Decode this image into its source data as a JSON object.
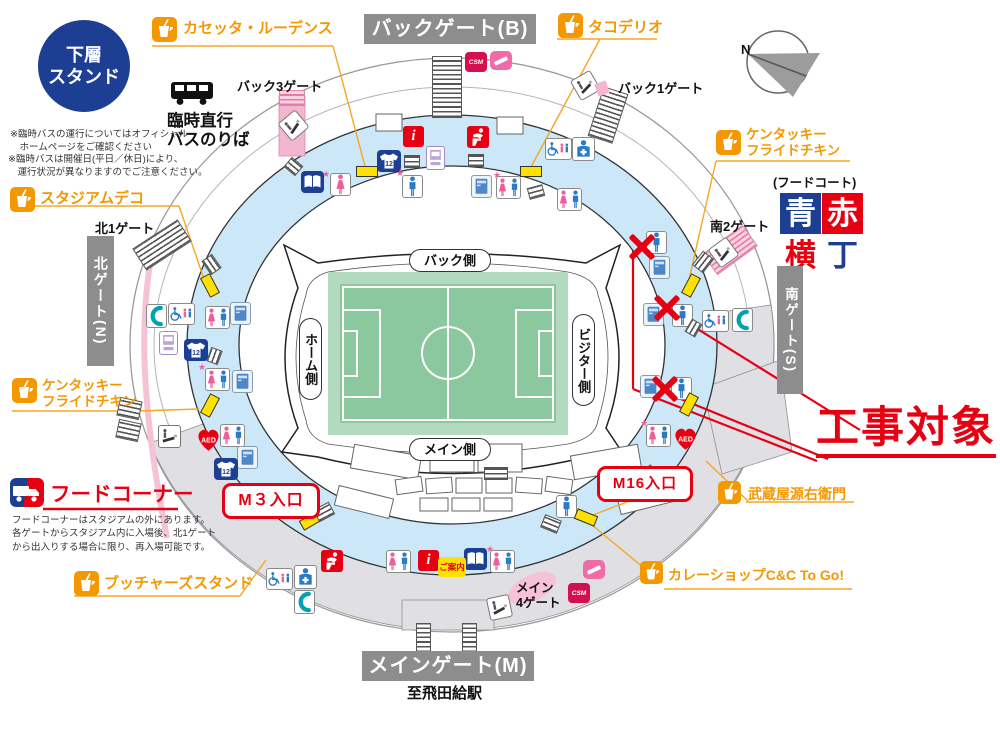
{
  "colors": {
    "orange": "#f39800",
    "red": "#e60012",
    "navy": "#1c3f94",
    "pink": "#ef6ca8",
    "ring_blue": "#cbe7f8",
    "pitch_green": "#8cc89d",
    "gate_gray": "#8d8d8d",
    "kiosk_yellow": "#ffe100"
  },
  "badge": {
    "text": "下層\nスタンド"
  },
  "shops": {
    "kasetta": "カセッタ・ルーデンス",
    "tako": "タコデリオ",
    "stadeco": "スタジアムデコ",
    "kfc_left": "ケンタッキー\nフライドチキン",
    "kfc_right": "ケンタッキー\nフライドチキン",
    "butchers": "ブッチャーズスタンド",
    "musashiya": "武蔵屋源右衛門",
    "curry": "カレーショップC&C To Go!"
  },
  "gates": {
    "back_gate": "バックゲート(B)",
    "main_gate": "メインゲート(M)",
    "north_gate": "北ゲート(N)",
    "south_gate": "南ゲート(S)",
    "back3": "バック3ゲート",
    "back1": "バック1ゲート",
    "north1": "北1ゲート",
    "south2": "南2ゲート",
    "main4": "メイン\n4ゲート",
    "station": "至飛田給駅"
  },
  "bus": {
    "title": "臨時直行\nバスのりば",
    "note1": "※臨時バスの運行についてはオフィシャル\n　ホームページをご確認ください",
    "note2": "※臨時バスは開催日(平日／休日)により、\n　運行状況が異なりますのでご注意ください。"
  },
  "food_corner": {
    "title": "フードコーナー",
    "note": "フードコーナーはスタジアムの外にあります。\n各ゲートからスタジアム内に入場後、北1ゲート\nから出入りする場合に限り、再入場可能です。"
  },
  "food_court": {
    "label": "(フードコート)",
    "c1": "青",
    "c2": "赤",
    "c3": "横",
    "c4": "丁"
  },
  "construction": {
    "label": "工事対象"
  },
  "entrances": {
    "m3": "M３入口",
    "m16": "M16入口"
  },
  "field": {
    "back": "バック側",
    "home": "ホーム側",
    "visitor": "ビジター側",
    "main": "メイン側"
  },
  "misc": {
    "guide": "ご案内",
    "north": "N"
  },
  "icon_text": {
    "aed": "AED",
    "csm": "CSM",
    "info": "i",
    "shirt": "12"
  },
  "icons": [
    {
      "type": "cup",
      "x": 152,
      "y": 17
    },
    {
      "type": "cup",
      "x": 558,
      "y": 13
    },
    {
      "type": "cup",
      "x": 10,
      "y": 187
    },
    {
      "type": "cup",
      "x": 12,
      "y": 378
    },
    {
      "type": "cup",
      "x": 74,
      "y": 571
    },
    {
      "type": "cup",
      "x": 716,
      "y": 130
    },
    {
      "type": "cup",
      "x": 718,
      "y": 481,
      "w": 23,
      "h": 23
    },
    {
      "type": "cup",
      "x": 640,
      "y": 561,
      "w": 23,
      "h": 23
    },
    {
      "type": "truck",
      "x": 10,
      "y": 478
    },
    {
      "type": "bus",
      "x": 170,
      "y": 80
    },
    {
      "type": "stairs",
      "x": 432,
      "y": 56,
      "w": 30,
      "h": 62
    },
    {
      "type": "stairs",
      "x": 595,
      "y": 89,
      "w": 26,
      "h": 52,
      "rot": 18
    },
    {
      "type": "stairs",
      "x": 135,
      "y": 232,
      "w": 54,
      "h": 26,
      "rot": -33
    },
    {
      "type": "stairs",
      "x": 416,
      "y": 623,
      "w": 15,
      "h": 30
    },
    {
      "type": "stairs",
      "x": 462,
      "y": 623,
      "w": 15,
      "h": 30
    },
    {
      "type": "stairs",
      "x": 484,
      "y": 467,
      "w": 24,
      "h": 13
    },
    {
      "type": "pinkstairs",
      "x": 279,
      "y": 90,
      "w": 26,
      "h": 16
    },
    {
      "type": "pinkstairs",
      "x": 705,
      "y": 237,
      "w": 50,
      "h": 26,
      "rot": -36
    },
    {
      "type": "smoking",
      "x": 712,
      "y": 241,
      "rot": -36
    },
    {
      "type": "csm",
      "x": 465,
      "y": 52
    },
    {
      "type": "cigpink",
      "x": 490,
      "y": 51
    },
    {
      "type": "smoking",
      "x": 282,
      "y": 114,
      "rot": -40
    },
    {
      "type": "smoking",
      "x": 574,
      "y": 74,
      "rot": -30
    },
    {
      "type": "pinkflag",
      "x": 596,
      "y": 82,
      "rot": -20
    },
    {
      "type": "infoi",
      "x": 403,
      "y": 126
    },
    {
      "type": "babycare",
      "x": 467,
      "y": 126
    },
    {
      "type": "vend",
      "x": 426,
      "y": 146
    },
    {
      "type": "shirt12",
      "x": 377,
      "y": 150
    },
    {
      "type": "stairs",
      "x": 404,
      "y": 155,
      "w": 16,
      "h": 13
    },
    {
      "type": "stairs",
      "x": 468,
      "y": 154,
      "w": 16,
      "h": 13
    },
    {
      "type": "stairs",
      "x": 286,
      "y": 160,
      "w": 15,
      "h": 13,
      "rot": 40
    },
    {
      "type": "stairs",
      "x": 528,
      "y": 186,
      "w": 16,
      "h": 12,
      "rot": -15
    },
    {
      "type": "book",
      "x": 301,
      "y": 171
    },
    {
      "type": "star",
      "x": 322,
      "y": 170
    },
    {
      "type": "toiletf",
      "x": 330,
      "y": 173
    },
    {
      "type": "kiosk",
      "x": 356,
      "y": 166
    },
    {
      "type": "star",
      "x": 396,
      "y": 169
    },
    {
      "type": "toiletm",
      "x": 402,
      "y": 175
    },
    {
      "type": "locker",
      "x": 471,
      "y": 175
    },
    {
      "type": "star",
      "x": 493,
      "y": 171
    },
    {
      "type": "toiletmf",
      "x": 496,
      "y": 176
    },
    {
      "type": "kiosk",
      "x": 520,
      "y": 166
    },
    {
      "type": "accw",
      "x": 545,
      "y": 138
    },
    {
      "type": "firstaid",
      "x": 572,
      "y": 137
    },
    {
      "type": "toiletmf",
      "x": 557,
      "y": 188
    },
    {
      "type": "phone",
      "x": 146,
      "y": 304
    },
    {
      "type": "accw",
      "x": 168,
      "y": 303
    },
    {
      "type": "vend",
      "x": 159,
      "y": 331
    },
    {
      "type": "shirt12",
      "x": 184,
      "y": 339
    },
    {
      "type": "toiletmf",
      "x": 205,
      "y": 306
    },
    {
      "type": "locker",
      "x": 230,
      "y": 302
    },
    {
      "type": "kiosk",
      "x": 199,
      "y": 280,
      "rot": 62
    },
    {
      "type": "stairs",
      "x": 203,
      "y": 258,
      "w": 17,
      "h": 13,
      "rot": 55
    },
    {
      "type": "stairs",
      "x": 207,
      "y": 350,
      "w": 15,
      "h": 12,
      "rot": -70
    },
    {
      "type": "star",
      "x": 198,
      "y": 363
    },
    {
      "type": "toiletmf",
      "x": 205,
      "y": 368
    },
    {
      "type": "locker",
      "x": 232,
      "y": 370
    },
    {
      "type": "kiosk",
      "x": 199,
      "y": 400,
      "rot": -62
    },
    {
      "type": "aed",
      "x": 195,
      "y": 427
    },
    {
      "type": "toiletmf",
      "x": 220,
      "y": 424
    },
    {
      "type": "smoking",
      "x": 158,
      "y": 425
    },
    {
      "type": "stairs",
      "x": 118,
      "y": 399,
      "w": 23,
      "h": 19,
      "rot": 12
    },
    {
      "type": "stairs",
      "x": 117,
      "y": 421,
      "w": 23,
      "h": 19,
      "rot": 12
    },
    {
      "type": "locker",
      "x": 237,
      "y": 446
    },
    {
      "type": "shirt12",
      "x": 214,
      "y": 458
    },
    {
      "type": "kiosk",
      "x": 300,
      "y": 515,
      "rot": -30
    },
    {
      "type": "stairs",
      "x": 315,
      "y": 505,
      "w": 18,
      "h": 14,
      "rot": -28
    },
    {
      "type": "babycare",
      "x": 321,
      "y": 550
    },
    {
      "type": "toiletmf",
      "x": 386,
      "y": 550
    },
    {
      "type": "infoi",
      "x": 418,
      "y": 550
    },
    {
      "type": "book",
      "x": 464,
      "y": 548
    },
    {
      "type": "star",
      "x": 486,
      "y": 545
    },
    {
      "type": "toiletmf",
      "x": 490,
      "y": 550
    },
    {
      "type": "smoking",
      "x": 488,
      "y": 596,
      "rot": -12
    },
    {
      "type": "csm",
      "x": 568,
      "y": 583
    },
    {
      "type": "cigpink",
      "x": 583,
      "y": 560
    },
    {
      "type": "accw",
      "x": 266,
      "y": 568
    },
    {
      "type": "firstaid",
      "x": 294,
      "y": 565
    },
    {
      "type": "phone",
      "x": 294,
      "y": 590
    },
    {
      "type": "toiletm",
      "x": 556,
      "y": 495
    },
    {
      "type": "kiosk",
      "x": 575,
      "y": 512,
      "rot": 22
    },
    {
      "type": "stairs",
      "x": 542,
      "y": 517,
      "w": 18,
      "h": 14,
      "rot": 22
    },
    {
      "type": "toiletm",
      "x": 646,
      "y": 231
    },
    {
      "type": "locker",
      "x": 649,
      "y": 256
    },
    {
      "type": "locker",
      "x": 643,
      "y": 303
    },
    {
      "type": "toiletm",
      "x": 672,
      "y": 304
    },
    {
      "type": "accw",
      "x": 702,
      "y": 310
    },
    {
      "type": "phone",
      "x": 732,
      "y": 308
    },
    {
      "type": "kiosk",
      "x": 680,
      "y": 280,
      "rot": -62
    },
    {
      "type": "stairs",
      "x": 694,
      "y": 255,
      "w": 18,
      "h": 14,
      "rot": -52
    },
    {
      "type": "stairs",
      "x": 686,
      "y": 322,
      "w": 15,
      "h": 12,
      "rot": -60
    },
    {
      "type": "locker",
      "x": 640,
      "y": 375
    },
    {
      "type": "toiletm",
      "x": 671,
      "y": 377
    },
    {
      "type": "kiosk",
      "x": 678,
      "y": 399,
      "rot": -62
    },
    {
      "type": "star",
      "x": 640,
      "y": 419
    },
    {
      "type": "toiletmf",
      "x": 646,
      "y": 424
    },
    {
      "type": "aed",
      "x": 672,
      "y": 426
    },
    {
      "type": "stairs",
      "x": 638,
      "y": 468,
      "w": 18,
      "h": 14,
      "rot": -33
    }
  ]
}
